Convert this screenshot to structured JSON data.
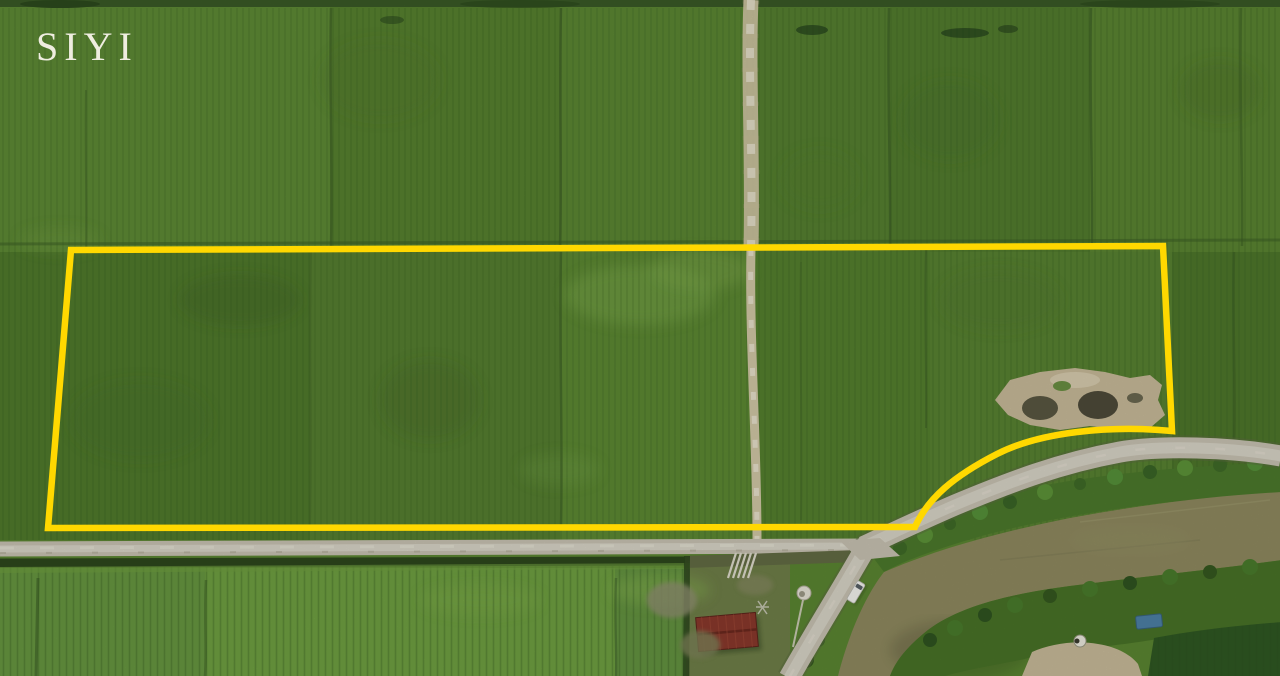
{
  "watermark": {
    "text": "SIYI",
    "color": "#EFEDE0"
  },
  "annotation": {
    "label": "field-boundary-polygon",
    "color": "#FFD800",
    "stroke_width": 6.5,
    "path_d": "M 71 250 L 1163 246 L 1172 431 C 1110 425 1040 432 997 454 C 954 476 928 498 915 527 L 48 528 Z"
  },
  "colors": {
    "field_green": "#5B8631",
    "field_green_dark": "#4E772B",
    "field_green_light": "#6FA041",
    "boundary_line": "#3A5C24",
    "dirt_path": "#CFC5A2",
    "gravel_road": "#C9C3B3",
    "ditch": "#2B431B",
    "river_water": "#8F8A5F",
    "bank_vegetation": "#4C7A2C",
    "sand": "#C8BB9A",
    "shed_roof": "#8A392C",
    "van": "#F4F4EF",
    "tarp": "#4D80A6"
  }
}
